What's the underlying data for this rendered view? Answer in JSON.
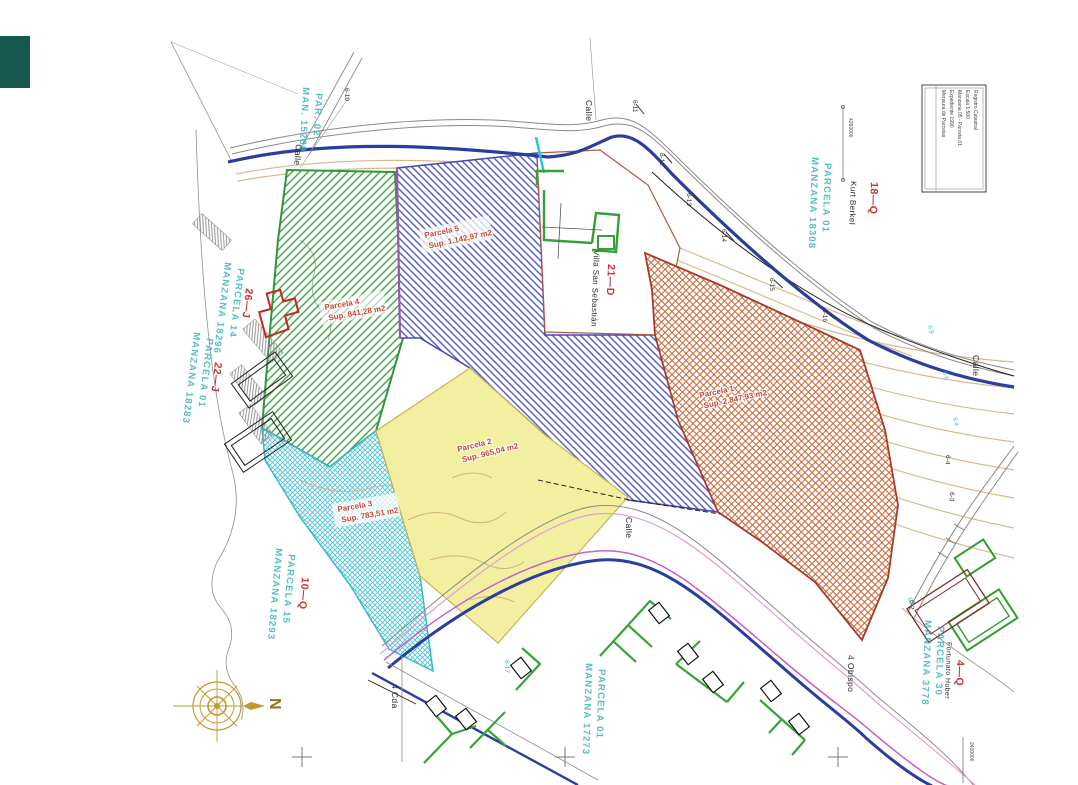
{
  "title_block": {
    "lines": [
      "Mensura de Parcelas",
      "Expediente 1990",
      "Manzana 05 - Parcela 01",
      "Escala 1:500",
      "Registro Catastral"
    ]
  },
  "compass": {
    "north": "N"
  },
  "parcels": [
    {
      "name": "Parcela 1",
      "area": "Sup. 2.847,93 m2"
    },
    {
      "name": "Parcela 2",
      "area": "Sup. 965,04 m2"
    },
    {
      "name": "Parcela 3",
      "area": "Sup. 783,51 m2"
    },
    {
      "name": "Parcela 4",
      "area": "Sup. 841,28 m2"
    },
    {
      "name": "Parcela 5",
      "area": "Sup. 1.142,97 m2"
    }
  ],
  "blocks": [
    {
      "line1": "MAN. 15289",
      "line2": "PAR. 02"
    },
    {
      "line1": "MANZANA 18296",
      "line2": "PARCELA 14"
    },
    {
      "line1": "MANZANA 18283",
      "line2": "PARCELA 01"
    },
    {
      "line1": "MANZANA 18293",
      "line2": "PARCELA 15"
    },
    {
      "line1": "MANZANA 17273",
      "line2": "PARCELA 01"
    },
    {
      "line1": "MANZANA 3778",
      "line2": "PARCELA 30"
    },
    {
      "line1": "MANZANA 18308",
      "line2": "PARCELA 01"
    }
  ],
  "codes": [
    "26—J",
    "22—J",
    "10—Q",
    "18—Q",
    "21—D",
    "4—Q"
  ],
  "owners": [
    "Kurt Berkel",
    "Villa San Sebastián",
    "Fortunato Huber"
  ],
  "streets": {
    "calle": "Calle",
    "cda": "4 Cda",
    "obispo": "4 Obispo"
  },
  "stations": [
    "6-10",
    "6-11",
    "6-12",
    "6-13",
    "6-14",
    "6-15",
    "6-16",
    "6-17",
    "6-4",
    "6-3",
    "6-2"
  ],
  "elevations": [
    "6.8",
    "6.6",
    "6.4",
    "6.2"
  ],
  "coordinates": [
    "4260000",
    "2400000"
  ],
  "colors": {
    "navy": "#2b3d9e",
    "magenta": "#c85ec8",
    "teal_text": "#3ab0c0",
    "red_text": "#cd3333",
    "green": "#3da04b",
    "blue": "#5a62c8",
    "cyan": "#3cc0d0",
    "yellow": "#f3efa0",
    "orange": "#cc6838",
    "tan": "#d6ba8c",
    "gold": "#c09a30"
  }
}
